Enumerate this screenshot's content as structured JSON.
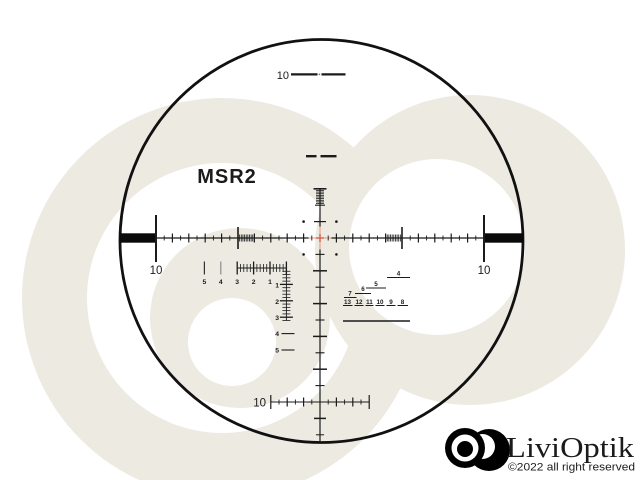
{
  "colors": {
    "background": "#ffffff",
    "watermark": "#edeae2",
    "reticle": "#1b1b1b",
    "center_orange": "#e6997d",
    "center_red": "#d06551"
  },
  "reticle": {
    "model": "MSR2",
    "elevation_top_label": "10",
    "windage_left_label": "10",
    "windage_right_label": "10",
    "holdover_bottom_label": "10",
    "ranging_scale": {
      "horizontal_labels": [
        "5",
        "4",
        "3",
        "2",
        "1"
      ],
      "vertical_labels": [
        "1",
        "2",
        "3",
        "4",
        "5"
      ]
    },
    "stadia_scale": {
      "upper_labels": [
        "7",
        "6",
        "5",
        "4"
      ],
      "lower_labels": [
        "13",
        "12",
        "11",
        "10",
        "9",
        "8"
      ]
    }
  },
  "branding": {
    "name": "LiviOptik",
    "copyright": "©2022 all right reserved"
  }
}
